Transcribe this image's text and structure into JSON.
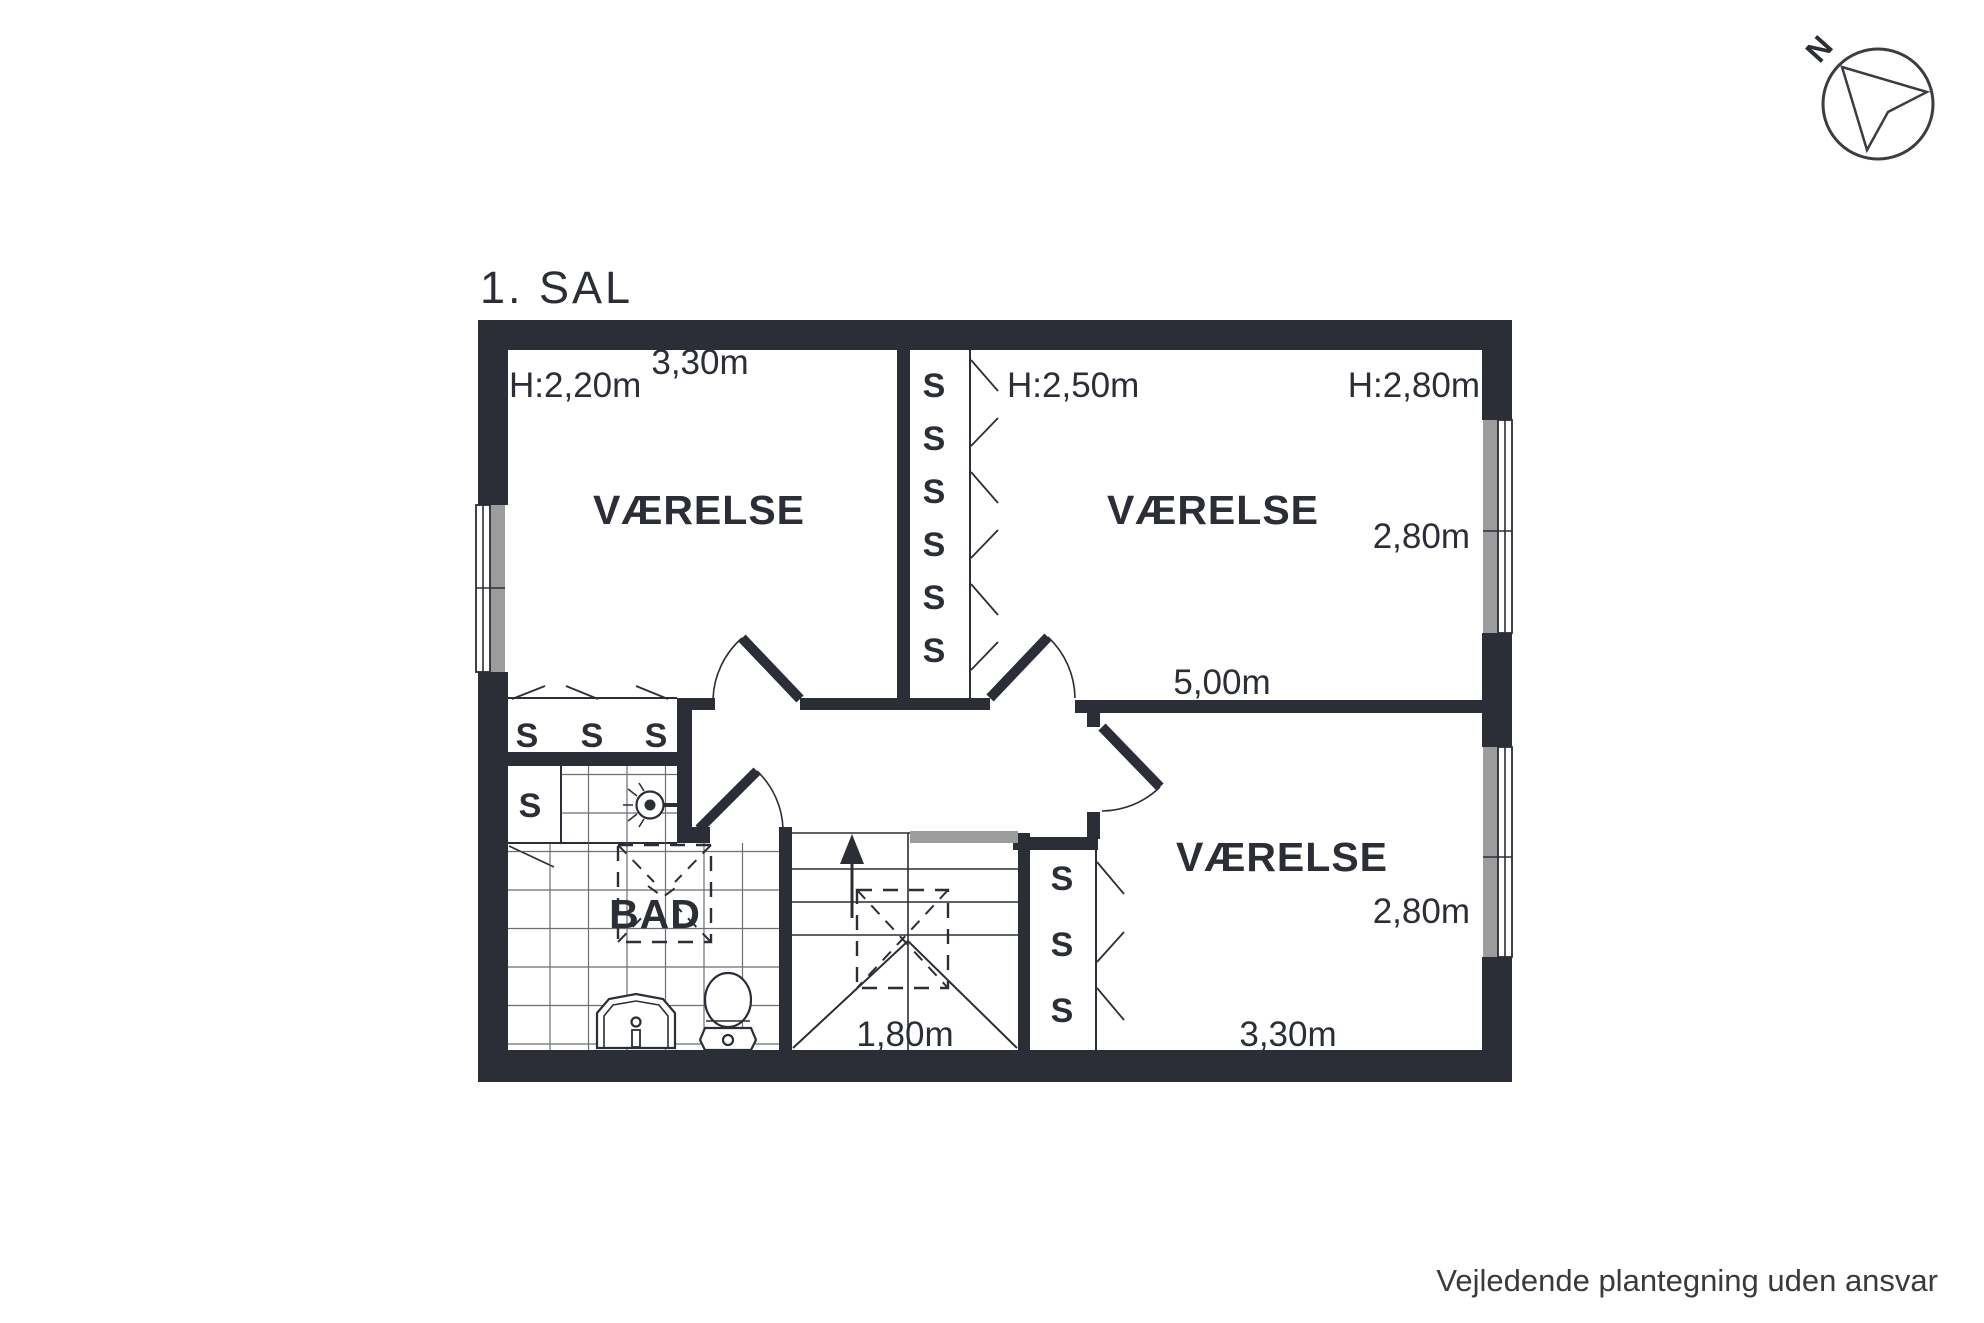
{
  "title": "1. SAL",
  "compass": {
    "north": "N"
  },
  "rooms": {
    "top_left": {
      "label": "VÆRELSE",
      "ceiling_height": "H:2,20m",
      "width": "3,30m"
    },
    "top_right": {
      "label": "VÆRELSE",
      "ceiling_height_left": "H:2,50m",
      "ceiling_height_right": "H:2,80m",
      "depth": "2,80m",
      "width": "5,00m"
    },
    "bottom_right": {
      "label": "VÆRELSE",
      "depth": "2,80m",
      "width": "3,30m"
    },
    "bathroom": {
      "label": "BAD"
    },
    "stairs": {
      "width": "1,80m"
    }
  },
  "closets": {
    "symbol": "S"
  },
  "footer": {
    "disclaimer": "Vejledende plantegning uden ansvar"
  },
  "colors": {
    "wall": "#2b2e36",
    "window_gray": "#9c9c9c",
    "railing_gray": "#9c9c9c",
    "text": "#2b2e36",
    "footer_text": "#3a3a3a"
  }
}
